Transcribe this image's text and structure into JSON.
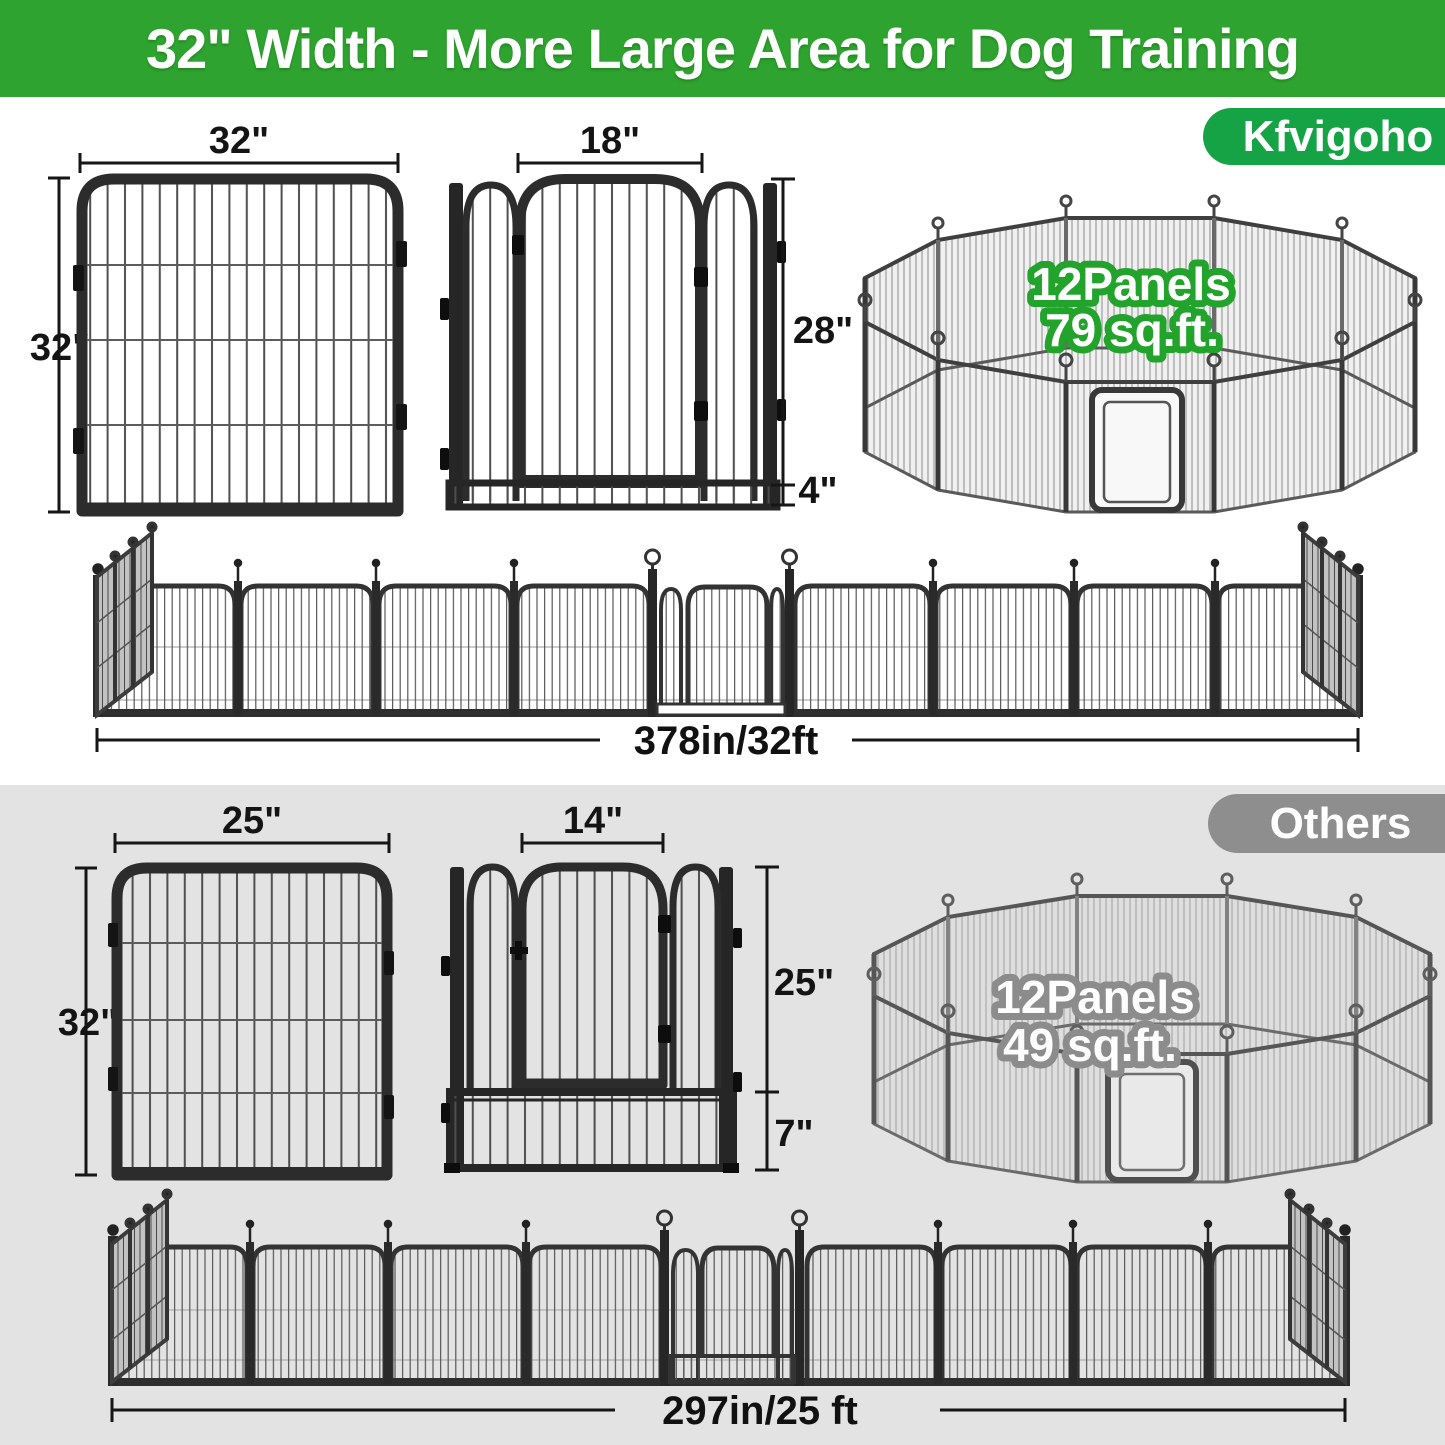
{
  "banner": {
    "title": "32\" Width - More Large Area for Dog Training"
  },
  "brand_section": {
    "badge_label": "Kfvigoho",
    "panel_diagram": {
      "width_label": "32\"",
      "height_label": "32\""
    },
    "door_diagram": {
      "door_width_label": "18\"",
      "panel_height_label": "28\"",
      "bottom_height_label": "4\""
    },
    "pen_overlay": {
      "panels_label": "12Panels",
      "area_label": "79 sq.ft."
    },
    "row_diagram": {
      "total_length_label": "378in/32ft"
    }
  },
  "others_section": {
    "badge_label": "Others",
    "panel_diagram": {
      "width_label": "25\"",
      "height_label": "32\""
    },
    "door_diagram": {
      "door_width_label": "14\"",
      "panel_height_label": "25\"",
      "bottom_height_label": "7\""
    },
    "pen_overlay": {
      "panels_label": "12Panels",
      "area_label": "49 sq.ft."
    },
    "row_diagram": {
      "total_length_label": "297in/25 ft"
    }
  },
  "colors": {
    "banner_green": "#2ea32f",
    "brand_badge_green": "#16a346",
    "pen_text_outline_green": "#21a32c",
    "others_badge_gray": "#8e8e8e",
    "others_section_bg": "#e3e3e3",
    "others_pen_text_outline_gray": "#8c8c8c",
    "frame_dark": "#2c2c2c",
    "dimension_text": "#141414"
  }
}
